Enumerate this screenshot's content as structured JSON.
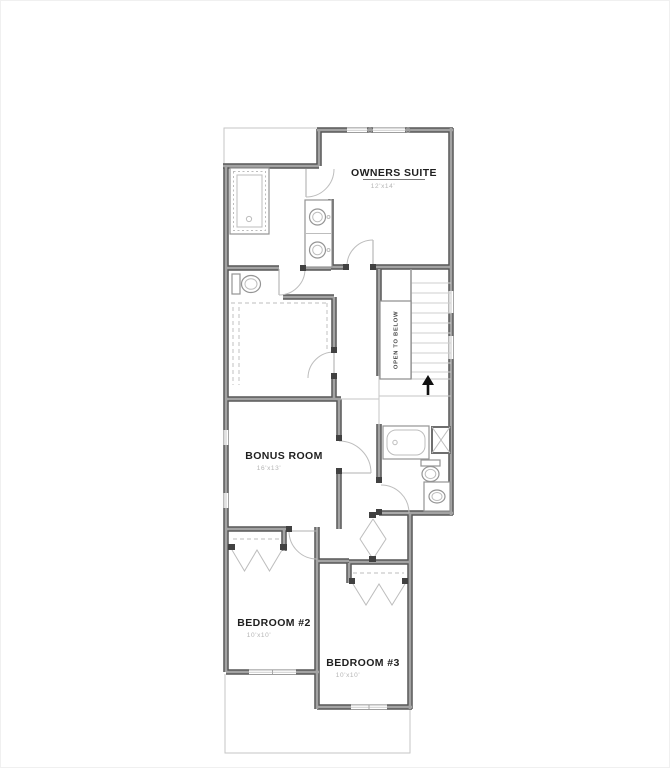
{
  "plan": {
    "rooms": {
      "owners_suite": {
        "name": "OWNERS SUITE",
        "dim": "12'x14'"
      },
      "bonus_room": {
        "name": "BONUS ROOM",
        "dim": "16'x13'"
      },
      "bedroom2": {
        "name": "BEDROOM #2",
        "dim": "10'x10'"
      },
      "bedroom3": {
        "name": "BEDROOM #3",
        "dim": "10'x10'"
      }
    },
    "stairs": {
      "open_to_below": "OPEN TO BELOW",
      "direction": "up"
    },
    "fixtures": {
      "owners_bath": [
        "walk-in-shower",
        "double-vanity",
        "toilet"
      ],
      "bath2": [
        "bathtub",
        "linen-closet",
        "toilet",
        "vanity-sink"
      ],
      "closets": [
        "walk-in-closet",
        "bedroom2-bifold-closet",
        "bedroom3-bifold-closet"
      ]
    },
    "colors": {
      "wall_edge": "#565656",
      "wall_core": "#a3a3a3",
      "thin_line": "#c6c6c6",
      "fixture_line": "#949494",
      "label_text": "#1f1f1f",
      "dim_text": "#b5b5b5",
      "arrow": "#111111"
    }
  }
}
